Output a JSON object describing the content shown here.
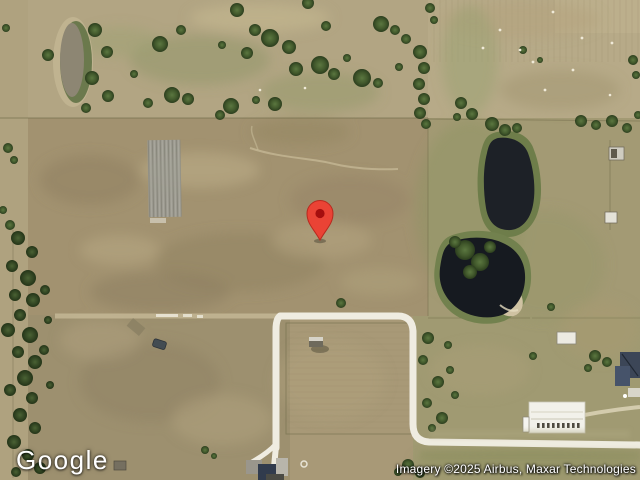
{
  "branding": {
    "logo_text": "Google"
  },
  "attribution": {
    "text": "Imagery ©2025 Airbus, Maxar Technologies"
  },
  "map": {
    "view": "satellite",
    "marker": {
      "label": "location-pin",
      "color": "#EA4335",
      "stroke": "#B8291E",
      "inner_color": "#A50E0E",
      "transform": "translate(320,240)"
    },
    "palette": {
      "field_tan": "#a89977",
      "field_light": "#b4a785",
      "grass_olive": "#8f9463",
      "tree_green": "#46622e",
      "pond_dark": "#1d2127",
      "road_white": "#efece1"
    }
  }
}
